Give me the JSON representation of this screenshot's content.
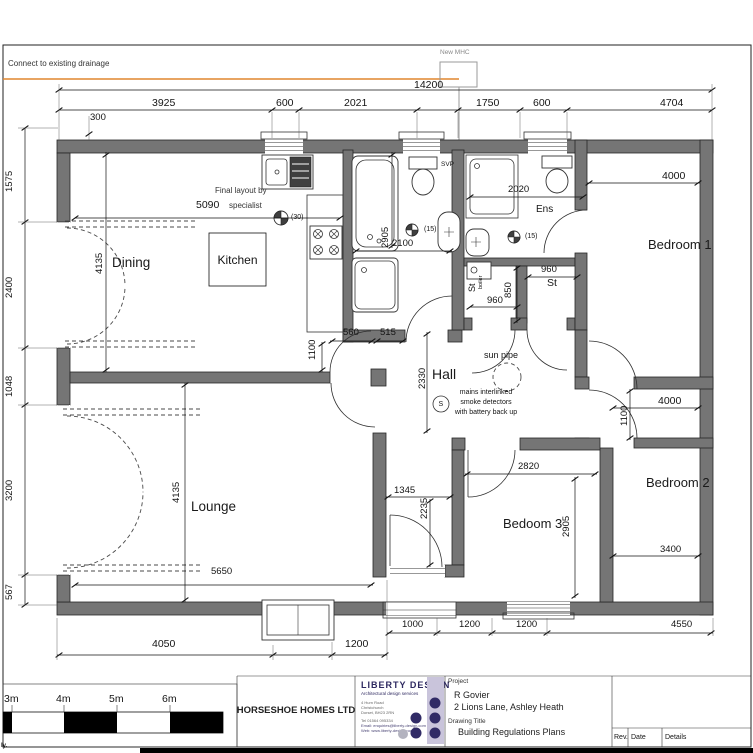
{
  "notes": {
    "drainage": "Connect to existing drainage",
    "new_mhc": "New MHC",
    "svp": "SVP",
    "final1": "Final layout by",
    "final2": "specialist",
    "fan30": "(30)",
    "fan15a": "(15)",
    "fan15b": "(15)",
    "sunpipe": "sun pipe",
    "smoke_s": "S",
    "smoke1": "mains interlinked",
    "smoke2": "smoke detectors",
    "smoke3": "with battery back up",
    "boiler": "boiler",
    "st_rot": "St",
    "corner": "ly."
  },
  "rooms": {
    "dining": "Dining",
    "kitchen": "Kitchen",
    "lounge": "Lounge",
    "hall": "Hall",
    "bed1": "Bedroom 1",
    "bed2": "Bedroom 2",
    "bed3": "Bedoom 3",
    "ens": "Ens",
    "st": "St"
  },
  "dims": {
    "overall": "14200",
    "t1": "3925",
    "t2": "600",
    "t3": "2021",
    "t4": "1750",
    "t5": "600",
    "t6": "4704",
    "w300": "300",
    "v1575": "1575",
    "v2400": "2400",
    "v1048": "1048",
    "v3200": "3200",
    "v567": "567",
    "d5090": "5090",
    "d4135a": "4135",
    "d4135b": "4135",
    "d5650": "5650",
    "d2905a": "2905",
    "d2100": "2100",
    "d1100a": "1100",
    "d560": "560",
    "d515": "515",
    "d2330": "2330",
    "d2020": "2020",
    "d960a": "960",
    "d850": "850",
    "d960b": "960",
    "d4000a": "4000",
    "d4000b": "4000",
    "d1100b": "1100",
    "d2820": "2820",
    "d2905b": "2905",
    "d3400": "3400",
    "d1345": "1345",
    "d2235": "2235",
    "b1000": "1000",
    "b1200a": "1200",
    "b1200b": "1200",
    "b4550": "4550",
    "b4050": "4050",
    "b1200c": "1200"
  },
  "scalebar": {
    "m3": "3m",
    "m4": "4m",
    "m5": "5m",
    "m6": "6m"
  },
  "titleblock": {
    "company": "HORSESHOE HOMES LTD",
    "firm": "LIBERTY DESIGN",
    "firm_sub": "Architectural design services",
    "addr1": "4 Hurn Road",
    "addr2": "Christchurch",
    "addr3": "Dorset, BH23 2RN",
    "tel": "Tel 01564 095334",
    "email": "Email: enquiries@liberty-design.com",
    "web": "Web: www.liberty-design.com",
    "project_label": "Project",
    "client": "R Govier",
    "address": "2 Lions Lane, Ashley Heath",
    "drawing_title_label": "Drawing Title",
    "drawing_title": "Building Regulations  Plans",
    "rev": "Rev.",
    "date": "Date",
    "details": "Details"
  }
}
